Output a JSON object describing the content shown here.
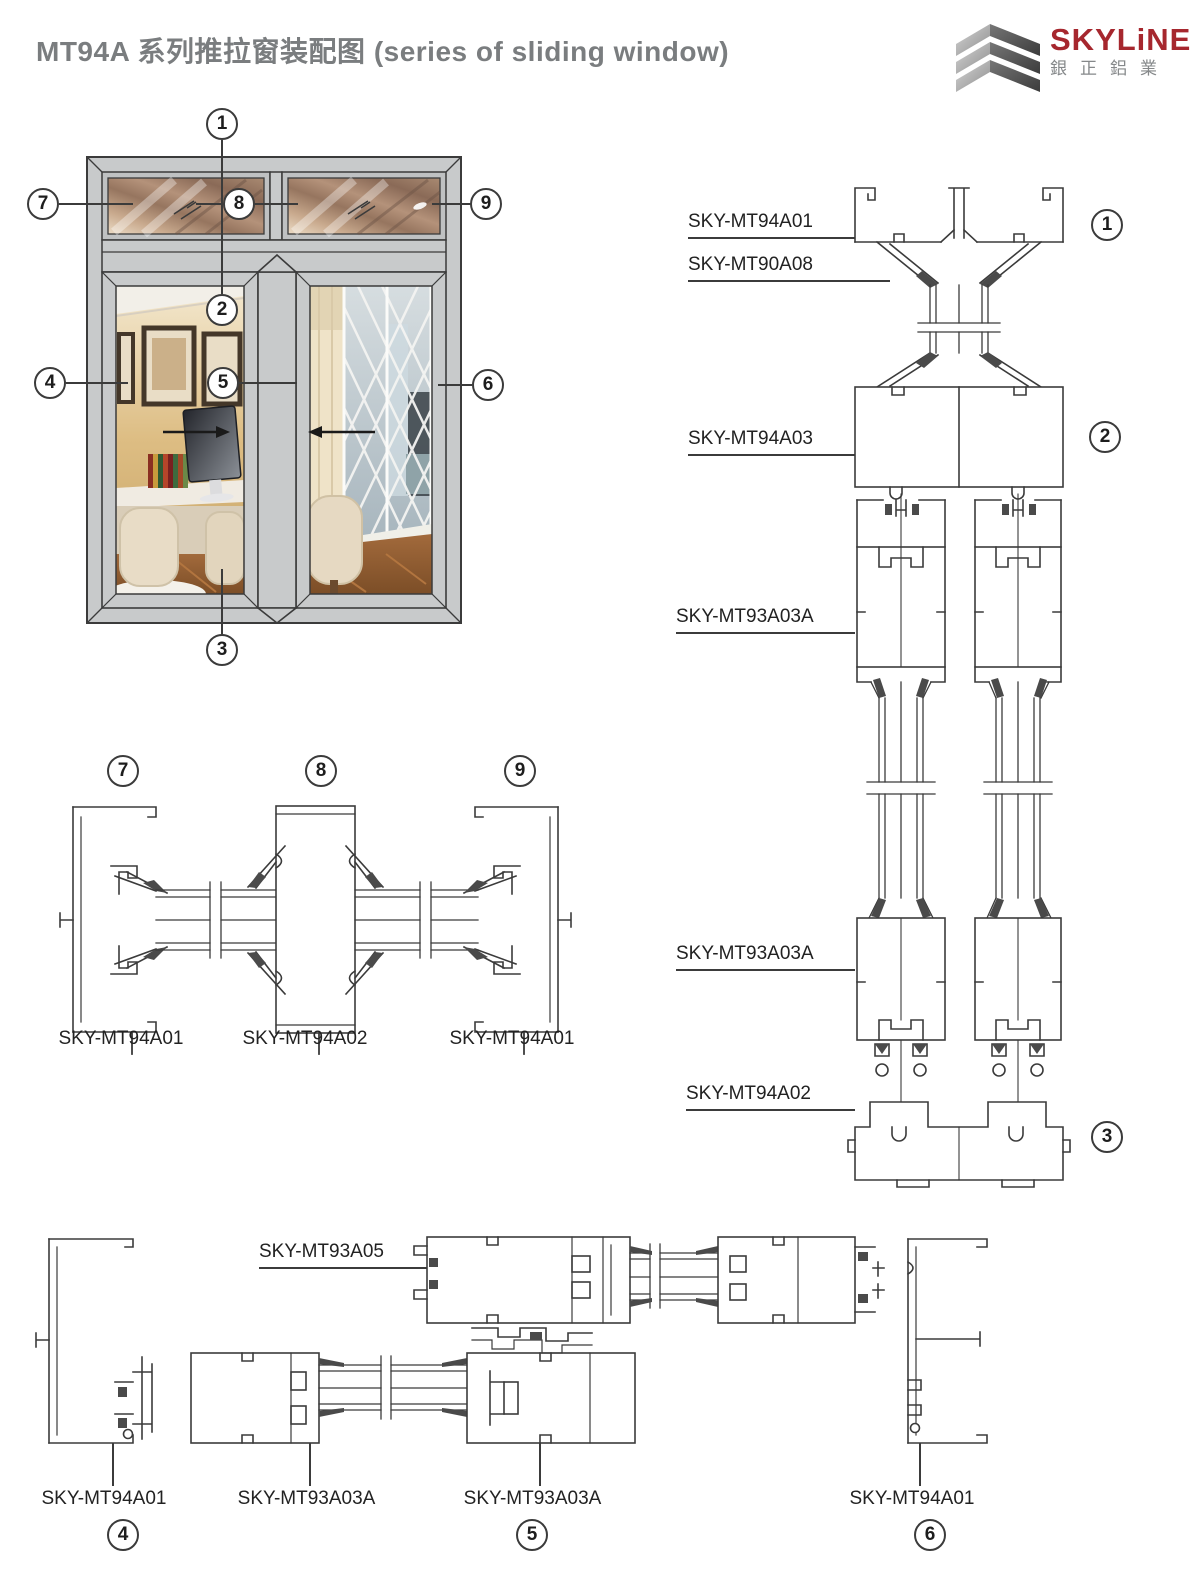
{
  "header": {
    "title": "MT94A 系列推拉窗装配图 (series of sliding window)",
    "logo": {
      "brand": "SKYLiNE",
      "brand_cn": "銀正鋁業",
      "brand_color": "#a6272e",
      "gray_color": "#85888a"
    }
  },
  "drawing": {
    "line_color": "#3b3b3b",
    "frame_gray": "#c8cacb"
  },
  "window_diagram": {
    "callouts": {
      "c1": "1",
      "c2": "2",
      "c3": "3",
      "c4": "4",
      "c5": "5",
      "c6": "6",
      "c7": "7",
      "c8": "8",
      "c9": "9"
    }
  },
  "vertical_section": {
    "labels": [
      {
        "text": "SKY-MT94A01"
      },
      {
        "text": "SKY-MT90A08"
      },
      {
        "text": "SKY-MT94A03"
      },
      {
        "text": "SKY-MT93A03A"
      },
      {
        "text": "SKY-MT93A03A"
      },
      {
        "text": "SKY-MT94A02"
      }
    ],
    "callouts": {
      "c1": "1",
      "c2": "2",
      "c3": "3"
    }
  },
  "horizontal_section": {
    "callouts": {
      "c7": "7",
      "c8": "8",
      "c9": "9"
    },
    "labels": [
      {
        "text": "SKY-MT94A01"
      },
      {
        "text": "SKY-MT94A02"
      },
      {
        "text": "SKY-MT94A01"
      }
    ]
  },
  "bottom_section": {
    "top_label": "SKY-MT93A05",
    "labels": [
      {
        "text": "SKY-MT94A01"
      },
      {
        "text": "SKY-MT93A03A"
      },
      {
        "text": "SKY-MT93A03A"
      },
      {
        "text": "SKY-MT94A01"
      }
    ],
    "callouts": {
      "c4": "4",
      "c5": "5",
      "c6": "6"
    }
  }
}
